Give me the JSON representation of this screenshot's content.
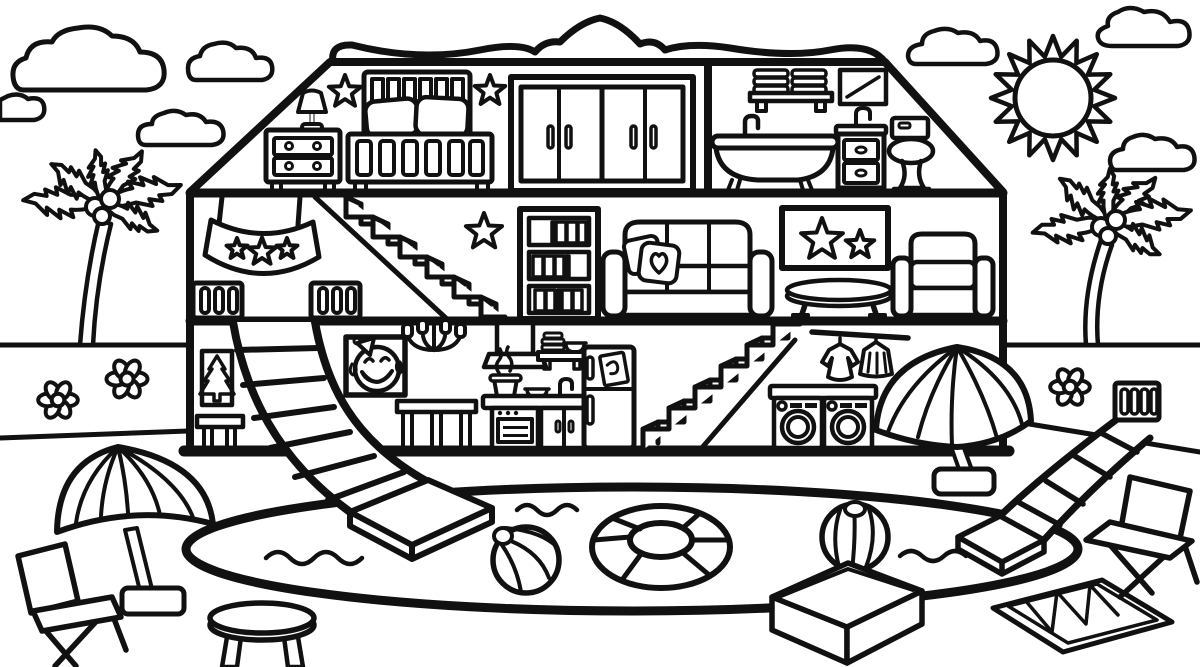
{
  "meta": {
    "title": "Dollhouse with pool coloring page",
    "style": "black-and-white line-art coloring book illustration",
    "background_color": "#ffffff",
    "line_color": "#111111"
  },
  "labels": {
    "scene": "Dollhouse beach coloring page",
    "sun": "Sun",
    "clouds": "Clouds",
    "palmLeft": "Palm tree (left)",
    "palmRight": "Palm tree (right)",
    "ground": "Beach ground lines",
    "house": "Dollhouse cutaway",
    "roofTrim": "Wavy roof trim",
    "bedroom": "Attic bedroom",
    "dresser": "Dresser with lamp",
    "bed": "Bed with pillows",
    "star": "Star decoration",
    "wardrobe": "Wardrobe closet",
    "bathroom": "Attic bathroom",
    "towelShelf": "Towel shelf",
    "mirror": "Mirror",
    "bathtub": "Clawfoot bathtub",
    "sinkCabinet": "Sink cabinet",
    "toilet": "Toilet",
    "livingRoom": "Middle floor living room",
    "banner": "Star banner",
    "window": "Window with bars",
    "stairsUpper": "Upper staircase",
    "bookshelf": "Bookshelf",
    "sofa": "Sofa with heart pillow",
    "wallArt": "Star wall art",
    "coffeeTable": "Round coffee table",
    "armchair": "Armchair",
    "groundFloor": "Ground floor",
    "treePicture": "Tree picture",
    "bench": "Bench",
    "slideLeft": "Curved slide into pool",
    "emojiPicture": "Laughing emoji picture",
    "chandelier": "Chandelier",
    "sideTable": "Side table",
    "kitchen": "Kitchen",
    "rangeHood": "Range hood",
    "dishShelf": "Dish shelf",
    "stove": "Stove counter with pot",
    "fridge": "Refrigerator",
    "stairsLower": "Lower staircase",
    "laundry": "Washing machines",
    "clothesRack": "Clothes rack",
    "umbrellaIndoor": "Beach umbrella (right)",
    "pool": "Swimming pool",
    "swimRing": "Swim ring float",
    "beachBall1": "Beach ball (in pool)",
    "beachBall2": "Beach ball (right)",
    "water": "Water ripples",
    "umbrellaLeft": "Beach umbrella (left)",
    "chairLeft": "Folding beach chair (left)",
    "chairRight": "Folding beach chair (right)",
    "stool": "Stool",
    "box": "Open box",
    "towelBeach": "Beach towel",
    "slideRight": "Pool slide (right)",
    "flowers": "Flowers"
  },
  "scene": {
    "sky": [
      "sun",
      "clouds"
    ],
    "outdoors_left": [
      "palmLeft",
      "flowers",
      "umbrellaLeft",
      "chairLeft",
      "stool"
    ],
    "outdoors_right": [
      "palmRight",
      "flowers",
      "slideRight",
      "chairRight",
      "towelBeach",
      "box",
      "umbrellaIndoor"
    ],
    "pool_area": [
      "pool",
      "water",
      "swimRing",
      "beachBall1",
      "beachBall2",
      "slideLeft"
    ],
    "house_attic": [
      "dresser",
      "bed",
      "star",
      "wardrobe",
      "towelShelf",
      "mirror",
      "bathtub",
      "sinkCabinet",
      "toilet"
    ],
    "house_middle": [
      "banner",
      "window",
      "stairsUpper",
      "star",
      "bookshelf",
      "sofa",
      "wallArt",
      "coffeeTable",
      "armchair"
    ],
    "house_ground": [
      "treePicture",
      "bench",
      "slideLeft",
      "emojiPicture",
      "chandelier",
      "sideTable",
      "rangeHood",
      "dishShelf",
      "stove",
      "fridge",
      "stairsLower",
      "laundry",
      "clothesRack",
      "umbrellaIndoor"
    ]
  }
}
